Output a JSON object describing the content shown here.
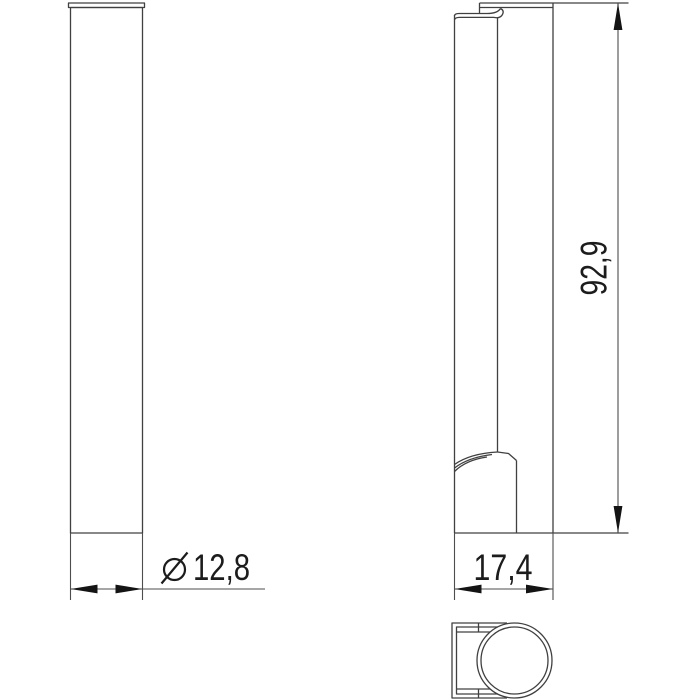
{
  "drawing": {
    "background": "#ffffff",
    "part_line_color": "#404040",
    "dimension_line_color": "#4d4d4d",
    "text_color": "#1c1c1c",
    "dimensions": {
      "diameter": {
        "symbol": "⌀",
        "value": "12,8",
        "full_label": "⌀ 12,8"
      },
      "depth": {
        "value": "17,4"
      },
      "height": {
        "value": "92,9"
      }
    }
  }
}
